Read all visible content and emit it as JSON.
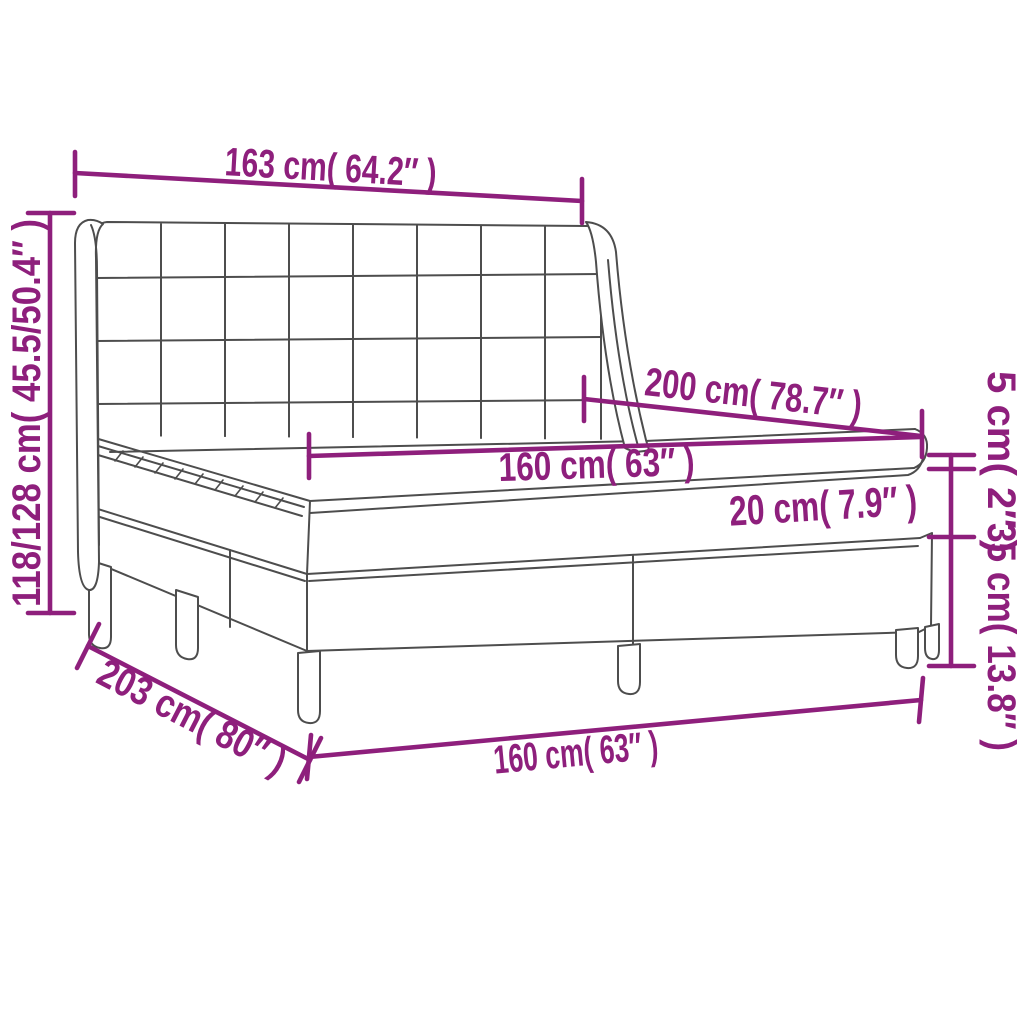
{
  "diagram": {
    "product": "box-spring-bed-with-wing-headboard",
    "colors": {
      "background": "#ffffff",
      "accent": "#8e1f7c",
      "line": "#4d4d4d"
    },
    "dimensions": {
      "headboard_width": "163 cm( 64.2″ )",
      "overall_height": "118/128 cm( 45.5/50.4″ )",
      "bed_length": "200 cm( 78.7″ )",
      "mattress_width": "160 cm( 63″ )",
      "mattress_height": "20 cm( 7.9″ )",
      "topper_height": "5 cm( 2″ )",
      "base_height": "35 cm( 13.8″ )",
      "base_length": "203 cm( 80″ )",
      "base_front_width": "160 cm( 63″ )"
    }
  }
}
